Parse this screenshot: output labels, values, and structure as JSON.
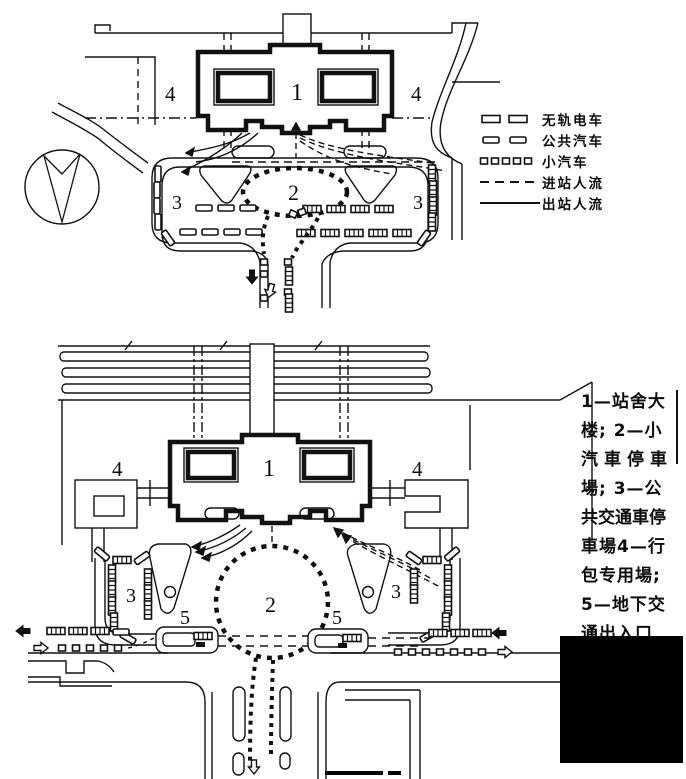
{
  "figure": {
    "description_lang": "zh",
    "labels": {
      "n1": "1",
      "n2": "2",
      "n3": "3",
      "n4": "4",
      "n5": "5"
    },
    "legend": {
      "items": [
        {
          "symbol": "trolleybus-icon",
          "label": "无轨电车"
        },
        {
          "symbol": "bus-icon",
          "label": "公共汽车"
        },
        {
          "symbol": "car-icon",
          "label": "小汽车"
        },
        {
          "symbol": "dashed-line",
          "label": "进站人流"
        },
        {
          "symbol": "solid-line",
          "label": "出站人流"
        }
      ]
    },
    "caption": {
      "full_text": "1—站舍大楼; 2—小汽車停車場; 3—公共交通車停車場 4—行包专用場; 5—地下交通出入口",
      "lines": [
        "1—站舍大",
        "楼; 2—小",
        "汽車停車",
        "場; 3—公",
        "共交通車停",
        "車場4—行",
        "包专用場;",
        "5—地下交",
        "通出入口",
        ""
      ]
    },
    "colors": {
      "ink": "#111111",
      "paper": "#ffffff",
      "block": "#000000"
    }
  }
}
